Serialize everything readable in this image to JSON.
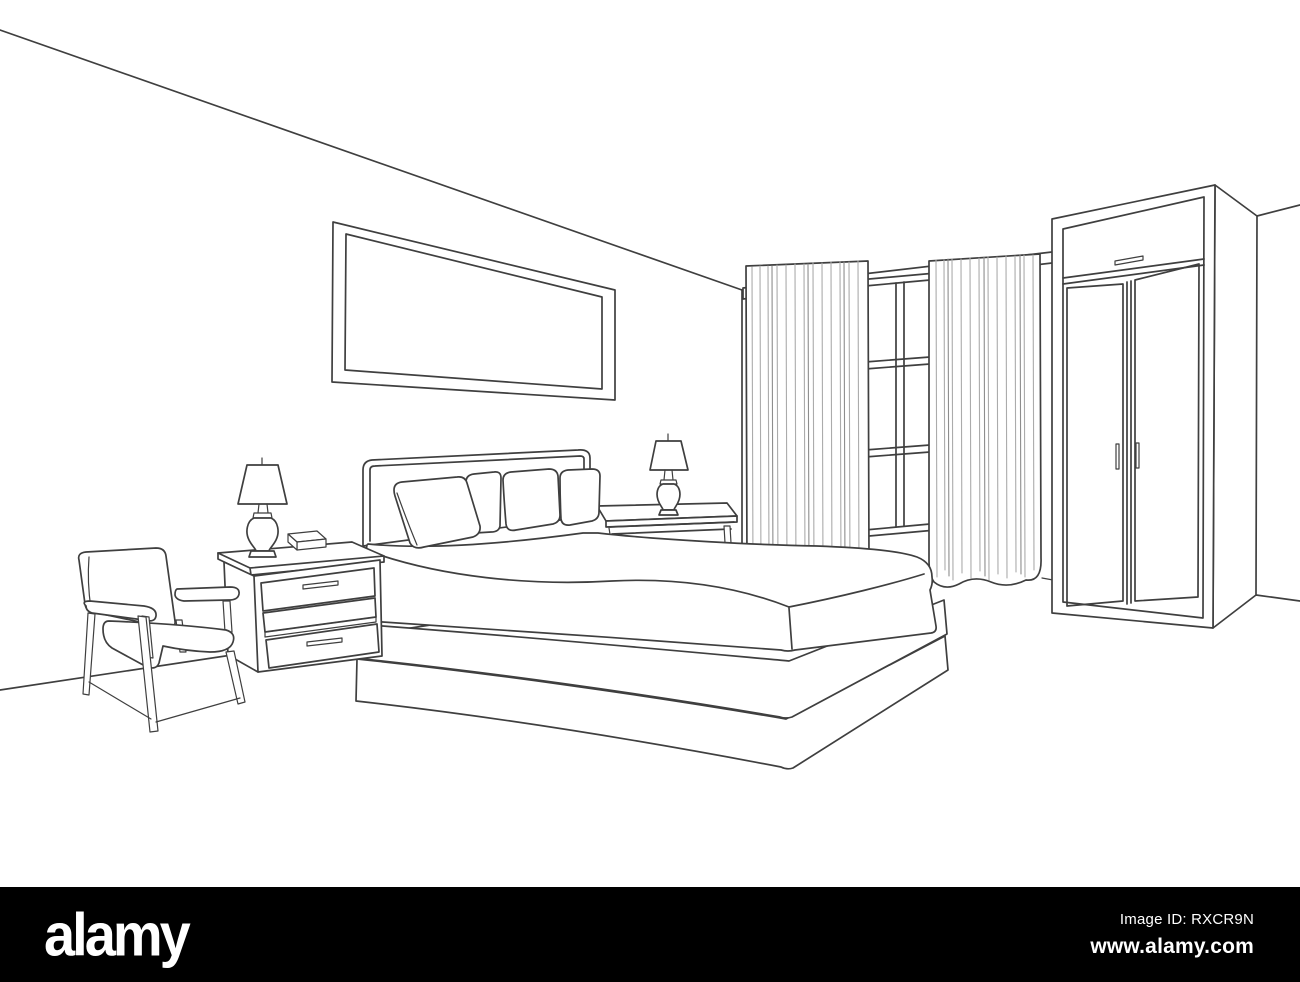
{
  "image": {
    "kind": "stock line-art illustration",
    "description": "Bedroom furniture interior outline sketch in one-point-style perspective",
    "width_px": 1300,
    "height_px": 982
  },
  "scene": {
    "objects": [
      "ceiling-line",
      "left-wall",
      "back-wall",
      "right-wall",
      "floor",
      "picture-frame",
      "curtain-rod",
      "window",
      "left-curtain",
      "right-curtain",
      "wardrobe",
      "wardrobe-doors",
      "bed",
      "headboard",
      "pillows",
      "mattress-blanket",
      "bed-platform-base",
      "right-nightstand",
      "table-lamp-right",
      "left-nightstand",
      "left-nightstand-drawers",
      "tissue-box",
      "table-lamp-left",
      "armchair"
    ],
    "pillow_count": 4,
    "wardrobe_door_count": 2,
    "nightstand_drawer_count": 2
  },
  "watermark": {
    "logo_text": "alamy",
    "image_id_label": "Image ID: RXCR9N",
    "website": "www.alamy.com"
  },
  "colors": {
    "background": "#ffffff",
    "line": "#3f3f3f",
    "curtain_fold_line": "#ababab",
    "watermark_bar": "#000000",
    "watermark_text": "#ffffff"
  }
}
